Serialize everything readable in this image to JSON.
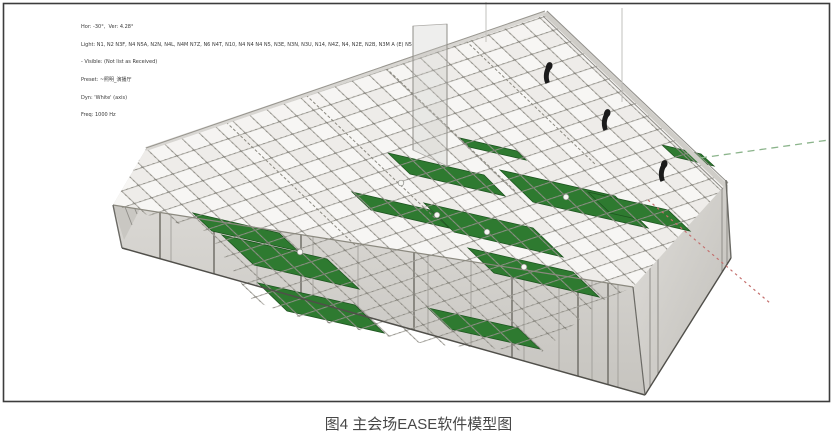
{
  "figure": {
    "caption": "图4 主会场EASE软件模型图"
  },
  "viewer": {
    "overlay_lines": [
      "Hor: -30°,  Ver: 4.28°",
      "Light: N1, N2 N3F, N4 N5A, N2N, N4L, N4M N7Z, N6 N4T, N10, N4 N4 N4 N5, N3E, N3N, N3U, N14, N4Z, N4, N2E, N2B, N3M A (E) N5",
      "- Visible: (Not list as Received)",
      "Preset: ~照明_演播厅",
      "Dyn: 'White' (axis)",
      "Freq: 1000 Hz"
    ],
    "colors": {
      "audience_green": "#2e7a30",
      "audience_grid": "#1e5420",
      "roof_base": "#eeece9",
      "grid_line": "#a3a19a",
      "wall_light": "#dad8d4",
      "wall_dark": "#c6c4bf",
      "speaker_dark": "#1b1b1b",
      "axis_green": "#8bb48b",
      "axis_red": "#c4706e",
      "frame_border": "#3c3c3c",
      "overlay_text": "#3a3a3a"
    },
    "model_elements": {
      "speaker_count": 3,
      "audience_area_count": 12,
      "listener_marker_count": 6
    }
  }
}
